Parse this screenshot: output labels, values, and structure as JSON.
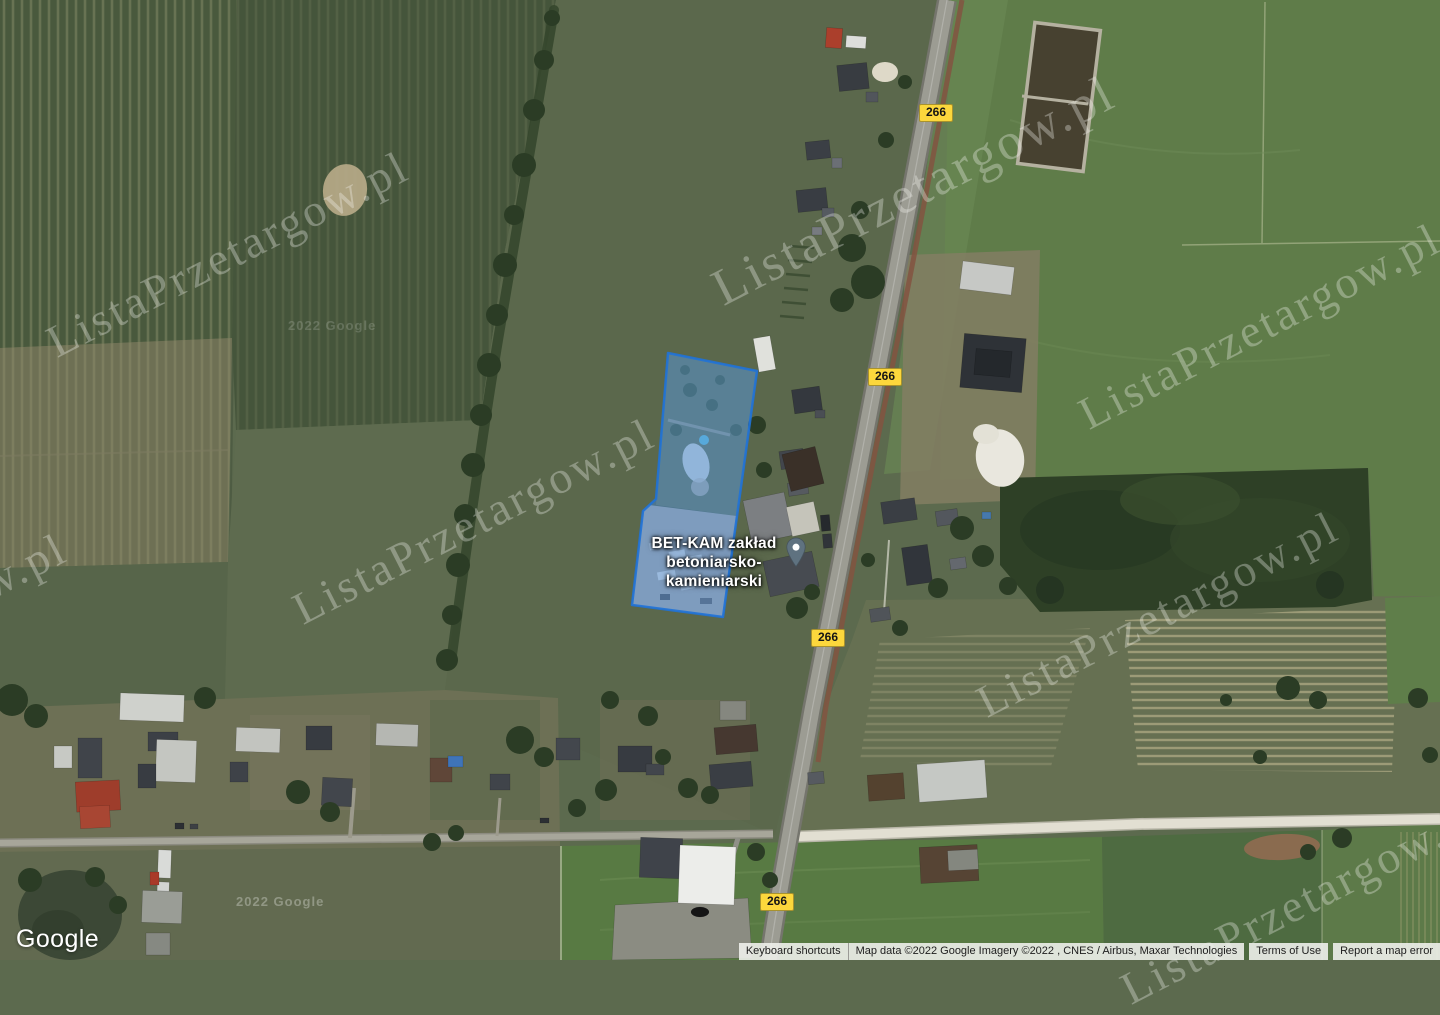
{
  "map": {
    "place_label": {
      "line1": "BET-KAM zakład",
      "line2": "betoniarsko-kamieniarski"
    },
    "road_shield": {
      "label": "266"
    },
    "watermark_text": "ListaPrzetargow.pl",
    "imagery_year_watermark": "2022 Google"
  },
  "branding": {
    "logo_text": "Google"
  },
  "attribution_bar": {
    "keyboard_shortcuts": "Keyboard shortcuts",
    "map_data": "Map data ©2022 Google Imagery ©2022 , CNES / Airbus, Maxar Technologies",
    "terms_of_use": "Terms of Use",
    "report_error": "Report a map error"
  },
  "colors": {
    "parcel_fill": "#3d85e0",
    "parcel_stroke": "#1f72d8",
    "shield_bg": "#fcd73c",
    "pin_color": "#5f7280"
  }
}
